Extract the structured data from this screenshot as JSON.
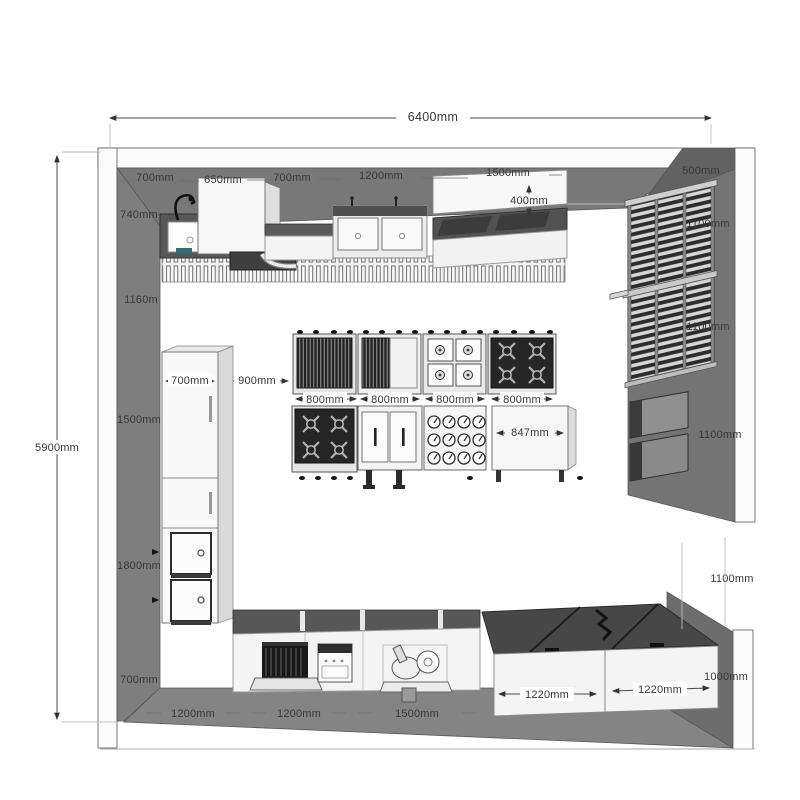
{
  "colors": {
    "wall_gray": "#7b7b7b",
    "wall_dark": "#646464",
    "floor_gray": "#848484",
    "counter_white": "#f4f4f4",
    "equipment_dark": "#262626",
    "dimension_text": "#383838"
  },
  "dims": {
    "overall_width": "6400mm",
    "overall_depth": "5900mm",
    "top_wall_sections": [
      "700mm",
      "650mm",
      "700mm",
      "1200mm",
      "1500mm"
    ],
    "shelf_depth": "400mm",
    "rack_depth": "500mm",
    "right_wall_sections": [
      "1100mm",
      "1100mm",
      "1100mm",
      "1100mm"
    ],
    "right_counter_height": "1000mm",
    "left_wall_sections": [
      "740mm",
      "1160m",
      "1500mm",
      "1800mm",
      "700mm"
    ],
    "fridge_width": "700mm",
    "aisle_width": "900mm",
    "island_units": [
      "800mm",
      "800mm",
      "800mm",
      "800mm"
    ],
    "island_end_unit": "847mm",
    "bottom_counter_units": [
      "1220mm",
      "1220mm"
    ],
    "bottom_wall_sections": [
      "1200mm",
      "1200mm",
      "1500mm"
    ]
  }
}
